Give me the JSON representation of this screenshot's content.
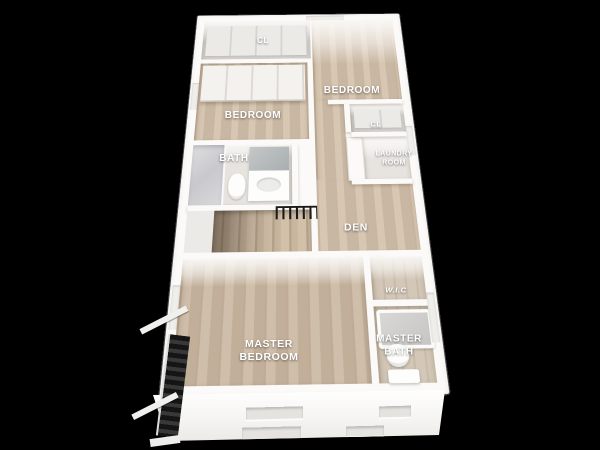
{
  "scene": {
    "background_color": "#000000",
    "wall_color": "#fbfaf8",
    "wood_floor_color": "#d3c1ab",
    "tile_floor_color": "#e7e4e0",
    "closet_floor_color": "#d7d6d2",
    "railing_color": "#1a1a1a",
    "label_color": "#ffffff"
  },
  "rooms": {
    "cl_top": {
      "label": "CL"
    },
    "bedroom_left": {
      "label": "BEDROOM"
    },
    "bedroom_right": {
      "label": "BEDROOM"
    },
    "cl_right": {
      "label": "CL"
    },
    "bath": {
      "label": "BATH"
    },
    "laundry": {
      "label": "LAUNDRY\nROOM"
    },
    "den": {
      "label": "DEN"
    },
    "master_bedroom": {
      "label": "MASTER\nBEDROOM"
    },
    "wic": {
      "label": "W.I.C"
    },
    "master_bath": {
      "label": "MASTER\nBATH"
    }
  },
  "features": [
    "staircase-with-black-railing",
    "exterior-fire-escape",
    "wardrobe-closet-doors",
    "shower",
    "toilet",
    "vanity-with-mirror",
    "bathtub",
    "front-facade-window-recesses"
  ]
}
